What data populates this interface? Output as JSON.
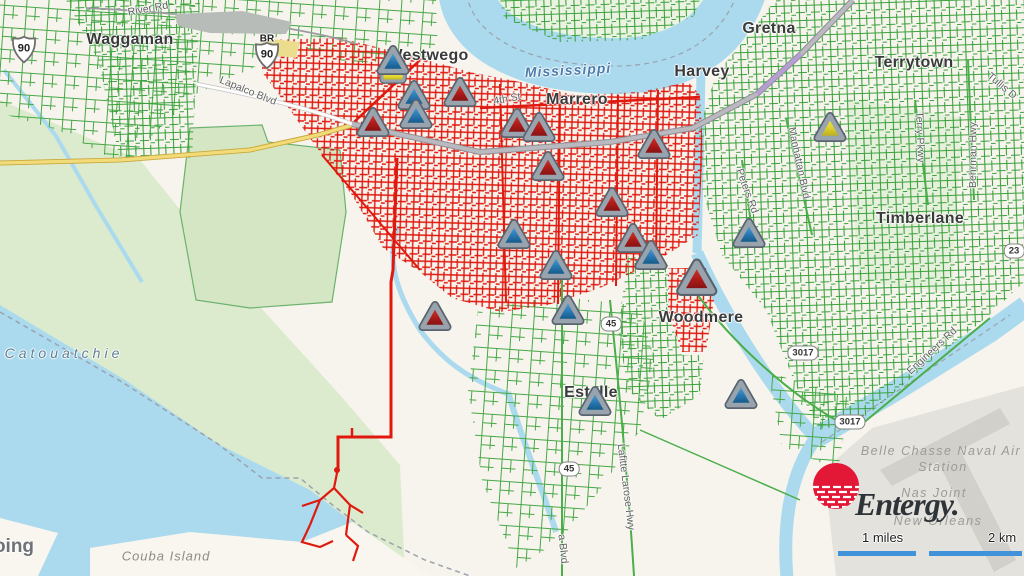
{
  "branding": {
    "logo_text": "Entergy.",
    "logo_color": "#e31837",
    "logo_text_color": "#2e3338"
  },
  "scale_bar": {
    "miles_label": "1 miles",
    "km_label": "2 km",
    "bar_color": "#4193d9"
  },
  "legend_colors": {
    "outage_lines": "#e0190f",
    "energized_lines": "#3aa23c",
    "water": "#abdaee",
    "marker_red": "#b01c19",
    "marker_blue": "#2b7ab4",
    "marker_yellow": "#ddd02c"
  },
  "map": {
    "labels": [
      {
        "text": "Waggaman",
        "x": 130,
        "y": 40,
        "cls": "town"
      },
      {
        "text": "Westwego",
        "x": 428,
        "y": 56,
        "cls": "town"
      },
      {
        "text": "Marrero",
        "x": 577,
        "y": 100,
        "cls": "town"
      },
      {
        "text": "Harvey",
        "x": 702,
        "y": 72,
        "cls": "town"
      },
      {
        "text": "Gretna",
        "x": 769,
        "y": 29,
        "cls": "town"
      },
      {
        "text": "Terrytown",
        "x": 914,
        "y": 63,
        "cls": "town"
      },
      {
        "text": "Timberlane",
        "x": 920,
        "y": 219,
        "cls": "town"
      },
      {
        "text": "Woodmere",
        "x": 701,
        "y": 318,
        "cls": "town"
      },
      {
        "text": "Estelle",
        "x": 591,
        "y": 393,
        "cls": "town"
      },
      {
        "text": "oing",
        "x": 14,
        "y": 547,
        "cls": "cut"
      },
      {
        "text": "River Rd",
        "x": 148,
        "y": 9,
        "cls": "road",
        "rot": -10
      },
      {
        "text": "Lapalco Blvd",
        "x": 248,
        "y": 91,
        "cls": "road",
        "rot": 22
      },
      {
        "text": "4th St",
        "x": 507,
        "y": 99,
        "cls": "road",
        "rot": -10
      },
      {
        "text": "Tullis D",
        "x": 1002,
        "y": 86,
        "cls": "road",
        "rot": 40
      },
      {
        "text": "Behrman Hwy",
        "x": 973,
        "y": 155,
        "cls": "road",
        "rot": -90
      },
      {
        "text": "Manhattan Blvd",
        "x": 799,
        "y": 163,
        "cls": "road",
        "rot": 78
      },
      {
        "text": "Terry Pkwy",
        "x": 920,
        "y": 137,
        "cls": "road",
        "rot": 88
      },
      {
        "text": "Peters Rd",
        "x": 747,
        "y": 191,
        "cls": "road",
        "rot": 70
      },
      {
        "text": "Engineers Rd",
        "x": 932,
        "y": 351,
        "cls": "road",
        "rot": -43
      },
      {
        "text": "Lafitte Larose Hwy",
        "x": 626,
        "y": 487,
        "cls": "road",
        "rot": 83
      },
      {
        "text": "a Blvd",
        "x": 563,
        "y": 549,
        "cls": "road",
        "rot": 84
      },
      {
        "text": "Mississippi",
        "x": 568,
        "y": 70,
        "cls": "water",
        "rot": -3
      },
      {
        "text": "Catouatchie",
        "x": 64,
        "y": 353,
        "cls": "lake"
      },
      {
        "text": "Belle Chasse Naval Air",
        "x": 941,
        "y": 451,
        "cls": "area"
      },
      {
        "text": "Station",
        "x": 943,
        "y": 467,
        "cls": "area"
      },
      {
        "text": "Nas Joint",
        "x": 934,
        "y": 493,
        "cls": "area"
      },
      {
        "text": "New Orleans",
        "x": 938,
        "y": 521,
        "cls": "area"
      },
      {
        "text": "Couba Island",
        "x": 166,
        "y": 556,
        "cls": "island"
      }
    ],
    "shields": [
      {
        "kind": "us",
        "text": "90",
        "x": 24,
        "y": 52
      },
      {
        "kind": "us",
        "text": "90",
        "x": 267,
        "y": 58,
        "banner": "BR"
      },
      {
        "kind": "box",
        "text": "45",
        "x": 611,
        "y": 324
      },
      {
        "kind": "box",
        "text": "45",
        "x": 569,
        "y": 469
      },
      {
        "kind": "box",
        "text": "3017",
        "x": 803,
        "y": 353
      },
      {
        "kind": "box",
        "text": "3017",
        "x": 850,
        "y": 422
      },
      {
        "kind": "box",
        "text": "23",
        "x": 1014,
        "y": 251
      }
    ],
    "markers": {
      "triangles": [
        {
          "x": 373,
          "y": 122,
          "c": "red"
        },
        {
          "x": 460,
          "y": 92,
          "c": "red"
        },
        {
          "x": 517,
          "y": 123,
          "c": "red"
        },
        {
          "x": 539,
          "y": 127,
          "c": "red"
        },
        {
          "x": 548,
          "y": 166,
          "c": "red"
        },
        {
          "x": 654,
          "y": 144,
          "c": "red"
        },
        {
          "x": 612,
          "y": 202,
          "c": "red"
        },
        {
          "x": 633,
          "y": 238,
          "c": "red"
        },
        {
          "x": 697,
          "y": 277,
          "c": "red",
          "s": 1.25
        },
        {
          "x": 435,
          "y": 316,
          "c": "red"
        },
        {
          "x": 393,
          "y": 60,
          "c": "blue"
        },
        {
          "x": 414,
          "y": 95,
          "c": "blue"
        },
        {
          "x": 416,
          "y": 114,
          "c": "blue"
        },
        {
          "x": 514,
          "y": 234,
          "c": "blue"
        },
        {
          "x": 556,
          "y": 265,
          "c": "blue"
        },
        {
          "x": 568,
          "y": 310,
          "c": "blue"
        },
        {
          "x": 651,
          "y": 255,
          "c": "blue"
        },
        {
          "x": 595,
          "y": 401,
          "c": "blue"
        },
        {
          "x": 741,
          "y": 394,
          "c": "blue"
        },
        {
          "x": 749,
          "y": 233,
          "c": "blue"
        },
        {
          "x": 830,
          "y": 127,
          "c": "yellow"
        }
      ],
      "bars": [
        {
          "x": 393,
          "y": 77
        }
      ]
    }
  }
}
